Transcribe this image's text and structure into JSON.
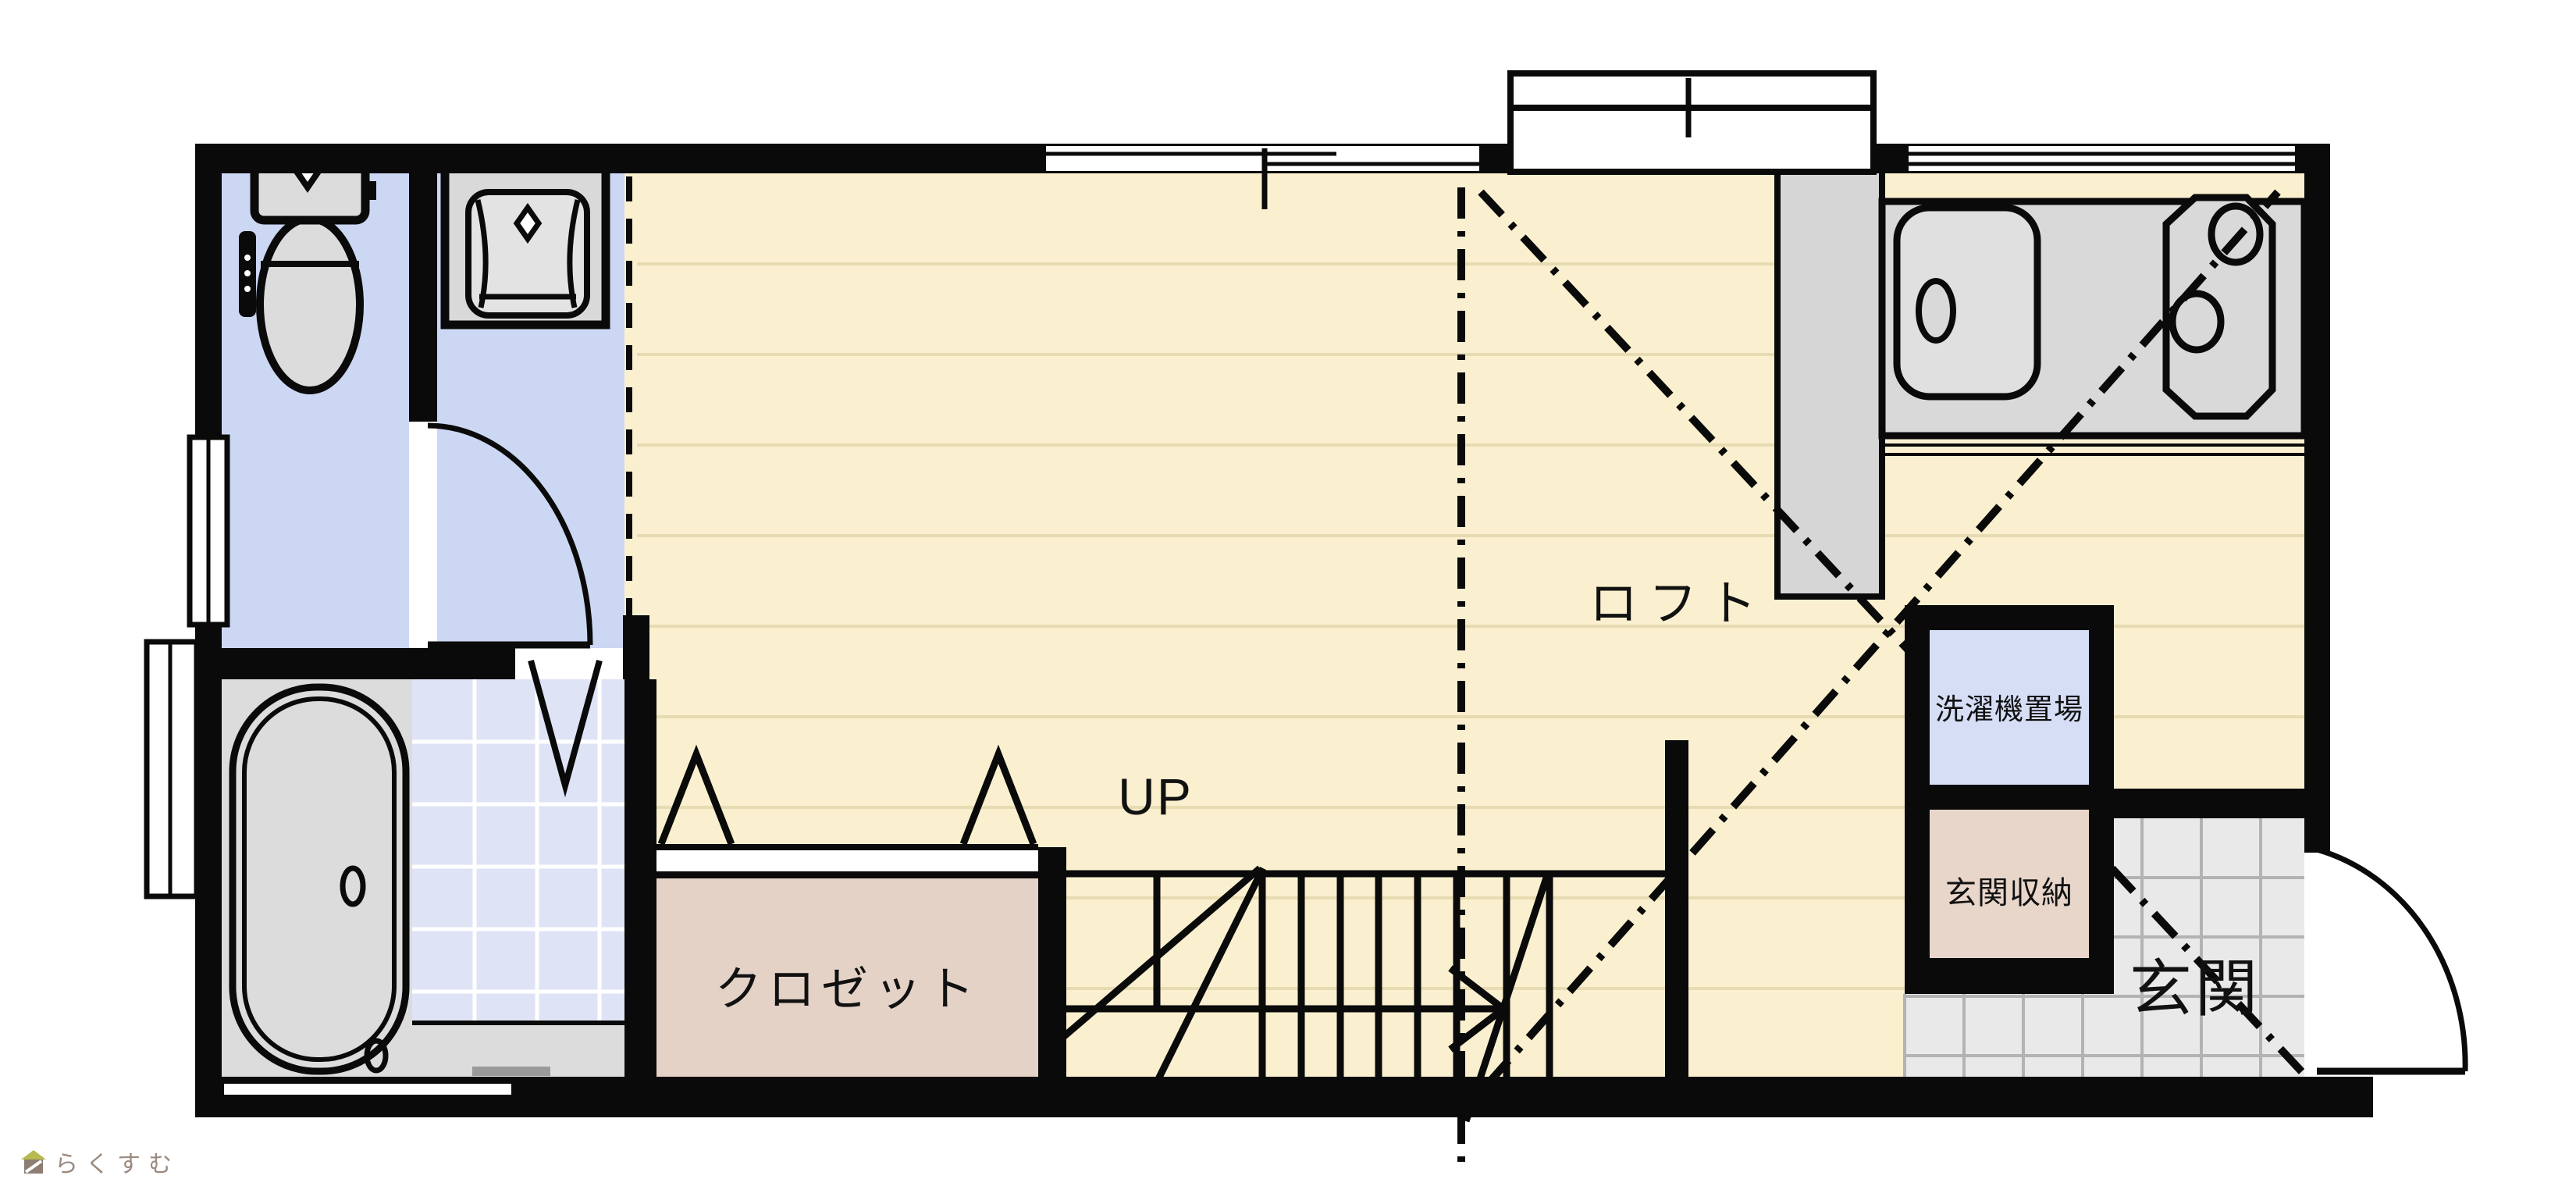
{
  "floorplan": {
    "type": "japanese-apartment-floor-plan",
    "labels": {
      "loft": "ロフト",
      "up": "UP",
      "closet": "クロゼット",
      "washer_area": "洗濯機置場",
      "entrance_storage": "玄関収納",
      "entrance": "玄関"
    },
    "watermark": {
      "text": "らくすむ"
    },
    "colors": {
      "wall": "#0a0a0a",
      "floor_wood": "#faf0d0",
      "floor_plank_line": "#e7dbb2",
      "wet_room_blue": "#ccd7f3",
      "bath_tile_blue": "#dfe3f6",
      "washer_room_blue": "#d6def6",
      "closet_pink": "#e4d2c7",
      "entrance_storage_pink": "#e9d6cb",
      "fixture_gray": "#dcdcdc",
      "counter_gray": "#d9d9d9",
      "entrance_tile_gray": "#e9e9e9",
      "entrance_tile_line": "#b3b3b3",
      "watermark_text": "#9b8a80"
    },
    "fixtures": [
      "toilet",
      "vanity-sink",
      "bathtub",
      "kitchen-sink",
      "stove-two-burner",
      "refrigerator-space",
      "staircase",
      "entrance-door",
      "washroom-door",
      "bath-folding-door",
      "closet-folding-doors",
      "windows"
    ]
  }
}
